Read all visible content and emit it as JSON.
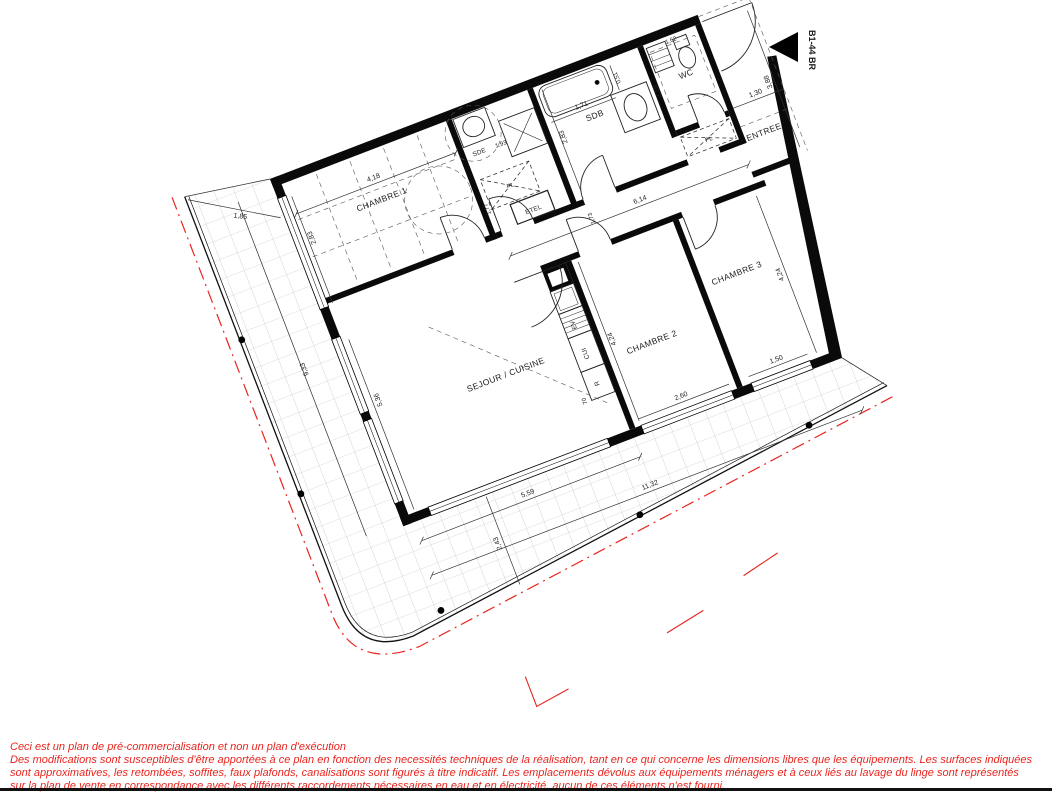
{
  "unit_ref": "B1-44 BR",
  "rooms": {
    "chambre1": "CHAMBRE 1",
    "sde": "SDE",
    "sdb": "SDB",
    "wc": "WC",
    "entree": "ENTREE",
    "sejour_cuisine": "SEJOUR / CUISINE",
    "chambre2": "CHAMBRE 2",
    "chambre3": "CHAMBRE 3",
    "etel": "ETEL",
    "placard_hall": "PL",
    "placard_entree": "PL"
  },
  "kitchen": {
    "sink": "EV",
    "counter": "CUI",
    "fridge": "R"
  },
  "dims": {
    "chambre1_width": "4,18",
    "chambre1_window": "2,83",
    "terrace_top_width": "1,85",
    "terrace_left_length": "9,33",
    "sejour_left_wall": "5,36",
    "sde_width": "1,93",
    "bathtub_length": "1,71",
    "bathtub_offset": "0,51",
    "sdb_depth": "2,83",
    "wc_depth": "2,16",
    "wc_width": "1,62",
    "entree_width": "1,30",
    "entree_depth": "3,88",
    "hall_length": "6,14",
    "hall_width": "1,73",
    "chambre1_door_offset": "1,77",
    "chambre2_depth": "4,24",
    "chambre3_depth": "4,24",
    "chambre2_window": "2,60",
    "chambre3_window": "1,50",
    "sejour_window": "5,59",
    "facade_total": "11,32",
    "terrace_bottom_width": "2,43",
    "door_width": "70"
  },
  "disclaimer": {
    "lines": [
      "Ceci est un plan de pré-commercialisation et non un plan d'exécution",
      "Des modifications sont susceptibles d'être apportées à ce plan en fonction des necessités techniques de la réalisation, tant en ce qui concerne les dimensions libres que les équipements. Les surfaces indiquées",
      "sont approximatives, les retombées, soffites, faux plafonds, canalisations sont figurés à titre indicatif. Les emplacements dévolus aux équipements ménagers et à ceux liés au lavage du linge sont représentés",
      "sur la plan de vente en correspondance avec les différents raccordements nécessaires en eau et en électricité, aucun de ces éléments n'est fourni."
    ]
  },
  "colors": {
    "accent_red": "#e8251f",
    "wall_black": "#0a0a0a"
  }
}
